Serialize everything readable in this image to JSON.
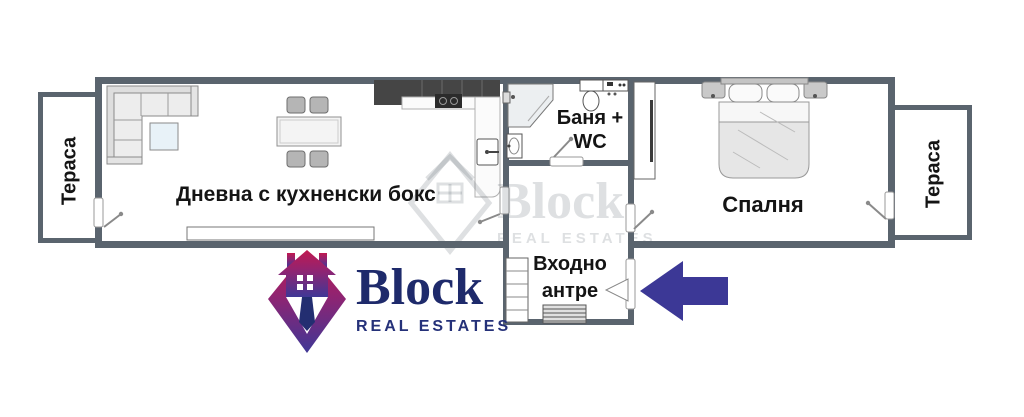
{
  "rooms": {
    "terrace_left": {
      "label": "Тераса"
    },
    "living": {
      "label": "Дневна с кухненски бокс"
    },
    "bathroom": {
      "label_line1": "Баня +",
      "label_line2": "WC"
    },
    "bedroom": {
      "label": "Спалня"
    },
    "entry": {
      "label_line1": "Входно",
      "label_line2": "антре"
    },
    "terrace_right": {
      "label": "Тераса"
    }
  },
  "branding": {
    "logo": {
      "name": "Block",
      "tagline": "REAL ESTATES"
    },
    "watermark": {
      "name": "Block",
      "tagline": "REAL ESTATES"
    }
  },
  "colors": {
    "wall": "#5a646e",
    "arrow": "#3c3896",
    "logo_navy": "#1e2a6b",
    "logo_crimson": "#c11950",
    "logo_purple": "#8f2472",
    "logo_indigo": "#3f3796"
  }
}
